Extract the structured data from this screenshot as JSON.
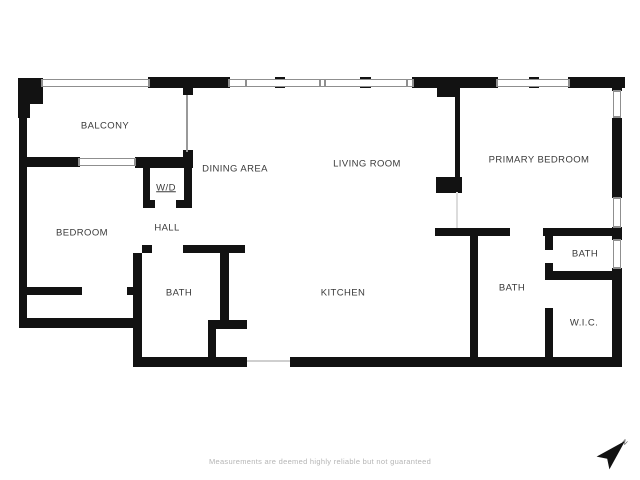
{
  "page": {
    "background": "#ffffff"
  },
  "floorplan": {
    "wall_color": "#121212",
    "window_frame_color": "#8f8f8f",
    "label_color": "#3a3a3a",
    "rooms": [
      {
        "name": "BALCONY",
        "cx": 105,
        "cy": 126
      },
      {
        "name": "DINING AREA",
        "cx": 235,
        "cy": 169
      },
      {
        "name": "LIVING ROOM",
        "cx": 367,
        "cy": 164
      },
      {
        "name": "PRIMARY BEDROOM",
        "cx": 539,
        "cy": 160
      },
      {
        "name": "BEDROOM",
        "cx": 82,
        "cy": 233
      },
      {
        "name": "W/D",
        "cx": 166,
        "cy": 188,
        "underline": true
      },
      {
        "name": "HALL",
        "cx": 167,
        "cy": 228
      },
      {
        "name": "BATH",
        "cx": 179,
        "cy": 293
      },
      {
        "name": "KITCHEN",
        "cx": 343,
        "cy": 293
      },
      {
        "name": "BATH",
        "cx": 512,
        "cy": 288
      },
      {
        "name": "BATH",
        "cx": 585,
        "cy": 254
      },
      {
        "name": "W.I.C.",
        "cx": 584,
        "cy": 323
      }
    ],
    "walls": [
      [
        18,
        78,
        12,
        40
      ],
      [
        30,
        78,
        13,
        26
      ],
      [
        19,
        116,
        8,
        212
      ],
      [
        148,
        77,
        82,
        11
      ],
      [
        412,
        77,
        86,
        11
      ],
      [
        568,
        77,
        57,
        11
      ],
      [
        612,
        77,
        10,
        14
      ],
      [
        612,
        118,
        10,
        80
      ],
      [
        612,
        227,
        10,
        13
      ],
      [
        612,
        268,
        10,
        99
      ],
      [
        290,
        357,
        332,
        10
      ],
      [
        133,
        357,
        114,
        10
      ],
      [
        19,
        318,
        123,
        10
      ],
      [
        133,
        253,
        9,
        107
      ],
      [
        19,
        157,
        61,
        10
      ],
      [
        135,
        157,
        58,
        11
      ],
      [
        183,
        87,
        10,
        8
      ],
      [
        183,
        150,
        10,
        9
      ],
      [
        143,
        165,
        7,
        38
      ],
      [
        184,
        165,
        8,
        43
      ],
      [
        143,
        200,
        12,
        8
      ],
      [
        176,
        200,
        16,
        8
      ],
      [
        142,
        245,
        10,
        8
      ],
      [
        183,
        245,
        62,
        8
      ],
      [
        220,
        250,
        9,
        72
      ],
      [
        208,
        320,
        39,
        9
      ],
      [
        208,
        320,
        8,
        42
      ],
      [
        19,
        287,
        63,
        8
      ],
      [
        127,
        287,
        8,
        8
      ],
      [
        435,
        228,
        75,
        8
      ],
      [
        543,
        228,
        74,
        8
      ],
      [
        470,
        236,
        8,
        124
      ],
      [
        437,
        83,
        23,
        14
      ],
      [
        455,
        86,
        5,
        93
      ],
      [
        436,
        177,
        26,
        16
      ],
      [
        545,
        228,
        8,
        22
      ],
      [
        545,
        263,
        8,
        14
      ],
      [
        545,
        271,
        72,
        9
      ],
      [
        545,
        308,
        8,
        52
      ],
      [
        275,
        77,
        10,
        11
      ],
      [
        360,
        77,
        11,
        11
      ],
      [
        529,
        77,
        10,
        11
      ]
    ],
    "windows": [
      {
        "rect": [
          41,
          79,
          109,
          8
        ],
        "orient": "h"
      },
      {
        "rect": [
          228,
          79,
          186,
          8
        ],
        "orient": "h",
        "ticks": [
          245,
          319,
          324,
          406
        ]
      },
      {
        "rect": [
          496,
          79,
          74,
          8
        ],
        "orient": "h"
      },
      {
        "rect": [
          78,
          158,
          58,
          8
        ],
        "orient": "h"
      },
      {
        "rect": [
          613,
          90,
          8,
          28
        ],
        "orient": "v"
      },
      {
        "rect": [
          613,
          197,
          8,
          31
        ],
        "orient": "v"
      },
      {
        "rect": [
          613,
          239,
          8,
          30
        ],
        "orient": "v"
      }
    ],
    "openings": [
      {
        "rect": [
          186,
          95,
          2,
          57
        ],
        "color": "#999999"
      },
      {
        "rect": [
          456,
          192,
          2,
          36
        ],
        "color": "#dcdcdc"
      },
      {
        "rect": [
          247,
          360,
          43,
          2
        ],
        "color": "#cfcfcf"
      }
    ]
  },
  "footer": {
    "disclaimer": "Measurements are deemed highly reliable but not guaranteed",
    "color": "#b5b5b5"
  },
  "compass": {
    "label": "N"
  }
}
